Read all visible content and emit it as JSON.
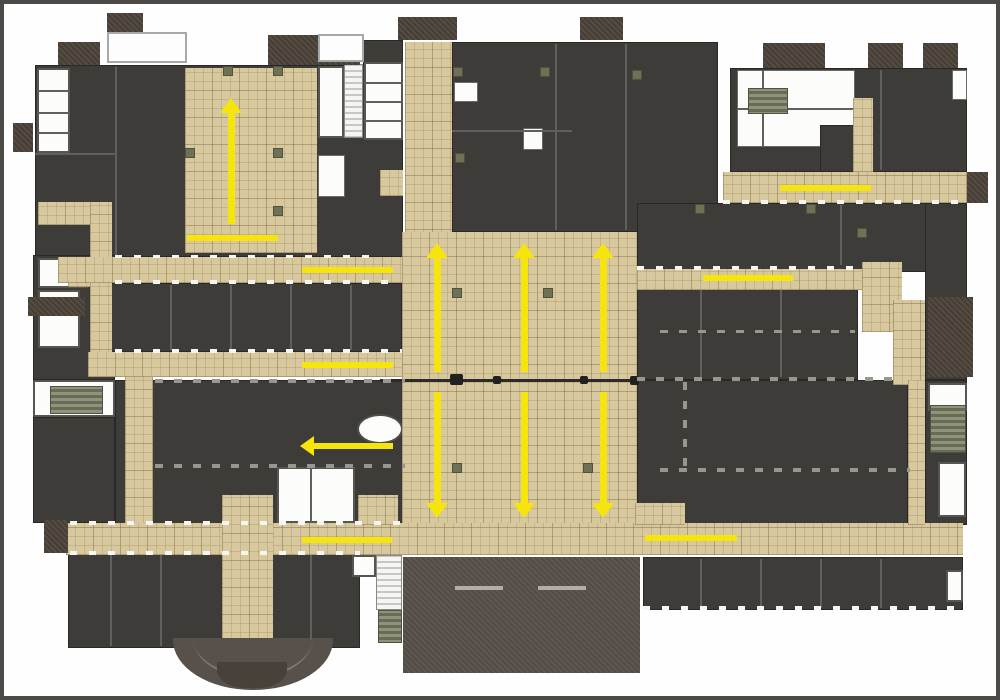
{
  "canvas": {
    "width": 1000,
    "height": 700,
    "background": "#fefefe",
    "frame_color": "#4c4a47"
  },
  "colors": {
    "corridor_tan": "#d8c89d",
    "room_dark": "#3e3c39",
    "roof_brown": "#4c4339",
    "auditorium_brown": "#57504a",
    "stair_olive": "#8e937c",
    "arrow_yellow": "#f5e50c",
    "wall_dark": "#2c2a27"
  },
  "floor_plan": {
    "regions": [
      [
        "ul-building",
        "dk",
        35,
        65,
        368,
        192
      ],
      [
        "strip-top-dark",
        "dk",
        363,
        40,
        40,
        25
      ],
      [
        "left-col-upper",
        "dk",
        33,
        255,
        82,
        125
      ],
      [
        "left-col-lower",
        "dk",
        33,
        417,
        82,
        106
      ],
      [
        "midleft-room-row",
        "dk",
        110,
        283,
        292,
        69
      ],
      [
        "midleft-hall",
        "dk",
        115,
        380,
        290,
        147
      ],
      [
        "bottomleft-building",
        "dk",
        68,
        553,
        292,
        95
      ],
      [
        "topcenter-building",
        "dk",
        452,
        42,
        266,
        190
      ],
      [
        "topright-building",
        "dk",
        730,
        68,
        237,
        104
      ],
      [
        "midright-upper",
        "dk",
        637,
        203,
        330,
        69
      ],
      [
        "midright-lower",
        "dk",
        637,
        287,
        221,
        93
      ],
      [
        "right-wing-upper",
        "dk",
        925,
        203,
        42,
        177
      ],
      [
        "bottomright-building",
        "dk",
        637,
        380,
        271,
        145
      ],
      [
        "right-wing-lower",
        "dk",
        925,
        380,
        42,
        145
      ],
      [
        "bottom-room-row",
        "dk",
        643,
        557,
        320,
        53
      ],
      [
        "auditorium-block",
        "aud",
        403,
        557,
        237,
        116
      ],
      [
        "ul-left-rooms",
        "white",
        37,
        68,
        33,
        85
      ],
      [
        "ul-left-div1",
        "wlineL",
        37,
        90,
        33,
        2
      ],
      [
        "ul-left-div2",
        "wlineL",
        37,
        112,
        33,
        2
      ],
      [
        "ul-left-div3",
        "wlineL",
        37,
        132,
        33,
        2
      ],
      [
        "ul-stairwell-white",
        "white",
        318,
        66,
        26,
        72
      ],
      [
        "ul-stairwell-stairs",
        "stairw",
        344,
        64,
        19,
        74
      ],
      [
        "ul-strip-rooms",
        "white",
        364,
        62,
        39,
        78
      ],
      [
        "ul-strip-div1",
        "wlineL",
        364,
        82,
        39,
        2
      ],
      [
        "ul-strip-div2",
        "wlineL",
        364,
        101,
        39,
        2
      ],
      [
        "ul-strip-div3",
        "wlineL",
        364,
        120,
        39,
        2
      ],
      [
        "ul-strip-white2",
        "whiteplain",
        318,
        155,
        27,
        42
      ],
      [
        "ul-strip-tan",
        "tan",
        380,
        170,
        23,
        26
      ],
      [
        "tc-room-white-a",
        "whiteplain",
        454,
        82,
        24,
        20
      ],
      [
        "tc-room-white-b",
        "whiteplain",
        523,
        128,
        20,
        22
      ],
      [
        "tr-courtyard",
        "whiteplain",
        737,
        70,
        118,
        77
      ],
      [
        "tr-court-div-v",
        "wlineL",
        762,
        70,
        2,
        77
      ],
      [
        "tr-court-div-h",
        "wlineL",
        737,
        108,
        118,
        2
      ],
      [
        "tr-stairs",
        "olive",
        748,
        88,
        40,
        26
      ],
      [
        "tr-court-room",
        "dk",
        820,
        125,
        35,
        47
      ],
      [
        "tr-white-notch",
        "whiteplain",
        952,
        70,
        15,
        30
      ],
      [
        "leftcol-room-a",
        "white",
        38,
        258,
        50,
        30
      ],
      [
        "leftcol-room-b",
        "white",
        38,
        290,
        42,
        58
      ],
      [
        "leftlow-rooms",
        "white",
        33,
        380,
        82,
        37
      ],
      [
        "leftlow-stairs",
        "olive",
        50,
        386,
        53,
        28
      ],
      [
        "midlow-rooms",
        "white",
        277,
        467,
        78,
        56
      ],
      [
        "midlow-div",
        "wlineL",
        310,
        467,
        2,
        56
      ],
      [
        "toilet-oval",
        "oval",
        357,
        414,
        46,
        30
      ],
      [
        "rightwing-room",
        "white",
        928,
        383,
        39,
        28
      ],
      [
        "rightwing-stairs",
        "olive",
        930,
        405,
        36,
        48
      ],
      [
        "br-room-white",
        "white",
        938,
        462,
        28,
        55
      ],
      [
        "bottomrow-room-white",
        "white",
        946,
        570,
        17,
        32
      ],
      [
        "bc-stair-white",
        "stairw",
        376,
        555,
        26,
        55
      ],
      [
        "bc-stairs",
        "olive",
        378,
        610,
        24,
        33
      ],
      [
        "bl-room-white",
        "white",
        352,
        555,
        24,
        22
      ],
      [
        "ul-plaza",
        "tan",
        185,
        68,
        132,
        185
      ],
      [
        "west-corr-h",
        "tan",
        38,
        202,
        72,
        23
      ],
      [
        "west-corr-v",
        "tan",
        90,
        202,
        22,
        175
      ],
      [
        "west-corr-stub",
        "tan",
        68,
        260,
        22,
        27
      ],
      [
        "corridor-north",
        "tan",
        58,
        257,
        349,
        26
      ],
      [
        "corridor-mid",
        "tan",
        88,
        352,
        317,
        25
      ],
      [
        "midleft-vert-corr",
        "tan",
        125,
        377,
        28,
        148
      ],
      [
        "central-spine",
        "tan",
        405,
        42,
        47,
        512
      ],
      [
        "central-plaza",
        "tan",
        402,
        232,
        235,
        322
      ],
      [
        "corridor-south",
        "tan",
        66,
        523,
        897,
        32
      ],
      [
        "corridor-northeast",
        "tan",
        723,
        172,
        244,
        31
      ],
      [
        "tr-vert-corr",
        "tan",
        853,
        98,
        20,
        74
      ],
      [
        "corridor-east",
        "tan",
        637,
        269,
        230,
        21
      ],
      [
        "east-junction-a",
        "tan",
        862,
        262,
        40,
        70
      ],
      [
        "east-junction-b",
        "tan",
        893,
        300,
        32,
        85
      ],
      [
        "east-vert-strip",
        "tan",
        908,
        380,
        17,
        145
      ],
      [
        "br-tan-block",
        "tan",
        635,
        503,
        50,
        22
      ],
      [
        "midlow-tan",
        "tan",
        358,
        495,
        40,
        30
      ],
      [
        "bl-vert-corr",
        "tan",
        222,
        495,
        51,
        147
      ],
      [
        "roof-stub-1",
        "brown",
        107,
        13,
        36,
        22
      ],
      [
        "roof-stub-2",
        "brown",
        58,
        42,
        42,
        23
      ],
      [
        "roof-stub-3",
        "brown",
        268,
        35,
        92,
        30
      ],
      [
        "roof-stub-4",
        "brown",
        398,
        17,
        59,
        23
      ],
      [
        "roof-stub-5",
        "brown",
        580,
        17,
        43,
        23
      ],
      [
        "roof-stub-6",
        "brown",
        763,
        43,
        62,
        25
      ],
      [
        "roof-stub-7",
        "brown",
        868,
        43,
        35,
        25
      ],
      [
        "roof-stub-8",
        "brown",
        923,
        43,
        35,
        25
      ],
      [
        "roof-stub-west-a",
        "brown",
        13,
        123,
        20,
        29
      ],
      [
        "roof-stub-west-b",
        "brown",
        28,
        297,
        57,
        19
      ],
      [
        "roof-stub-west-c",
        "brown",
        44,
        520,
        24,
        33
      ],
      [
        "roof-stub-east",
        "brown",
        967,
        172,
        21,
        31
      ],
      [
        "roof-block-east",
        "brown",
        928,
        297,
        45,
        80
      ],
      [
        "skylight-1",
        "skylight",
        107,
        32,
        80,
        31
      ],
      [
        "skylight-2",
        "skylight",
        318,
        34,
        46,
        28
      ],
      [
        "entry-fan",
        "fan",
        173,
        638,
        160,
        52
      ],
      [
        "entry-fan-arc",
        "fanline",
        193,
        638,
        120,
        40
      ],
      [
        "entry-fan-stub",
        "fanstub",
        217,
        662,
        70,
        26
      ],
      [
        "stage-line-1",
        "stageline",
        455,
        586,
        48,
        4
      ],
      [
        "stage-line-2",
        "stageline",
        538,
        586,
        48,
        4
      ],
      [
        "plaza-joint-line",
        "linedark",
        380,
        379,
        257,
        3
      ],
      [
        "joint-door-1",
        "blob",
        450,
        374,
        13,
        11
      ],
      [
        "joint-door-2",
        "blob",
        493,
        376,
        8,
        8
      ],
      [
        "joint-door-3",
        "blob",
        580,
        376,
        8,
        8
      ],
      [
        "joint-door-4",
        "blob",
        630,
        376,
        9,
        9
      ],
      [
        "div-ul-v",
        "wlineL",
        115,
        67,
        2,
        188
      ],
      [
        "div-ul-h",
        "wlineL",
        35,
        153,
        80,
        2
      ],
      [
        "div-tc-v1",
        "wlineL",
        555,
        44,
        2,
        186
      ],
      [
        "div-tc-v2",
        "wlineL",
        625,
        44,
        2,
        186
      ],
      [
        "div-tc-h",
        "wlineL",
        452,
        130,
        120,
        2
      ],
      [
        "div-tr-v",
        "wlineL",
        880,
        70,
        2,
        100
      ],
      [
        "div-mr-v1",
        "wlineL",
        700,
        290,
        2,
        87
      ],
      [
        "div-mr-v2",
        "wlineL",
        780,
        290,
        2,
        87
      ],
      [
        "div-mr-v3",
        "wlineL",
        840,
        205,
        2,
        60
      ],
      [
        "div-row-1",
        "wlineL",
        170,
        285,
        2,
        65
      ],
      [
        "div-row-2",
        "wlineL",
        230,
        285,
        2,
        65
      ],
      [
        "div-row-3",
        "wlineL",
        290,
        285,
        2,
        65
      ],
      [
        "div-row-4",
        "wlineL",
        350,
        285,
        2,
        65
      ],
      [
        "div-bl-1",
        "wlineL",
        110,
        555,
        2,
        91
      ],
      [
        "div-bl-2",
        "wlineL",
        160,
        555,
        2,
        91
      ],
      [
        "div-bl-3",
        "wlineL",
        310,
        555,
        2,
        85
      ],
      [
        "div-brow-1",
        "wlineL",
        700,
        559,
        2,
        49
      ],
      [
        "div-brow-2",
        "wlineL",
        760,
        559,
        2,
        49
      ],
      [
        "div-brow-3",
        "wlineL",
        820,
        559,
        2,
        49
      ],
      [
        "div-brow-4",
        "wlineL",
        880,
        559,
        2,
        49
      ],
      [
        "gaps-corrN-bottom",
        "dash",
        115,
        280,
        285,
        4
      ],
      [
        "gaps-corrM-top",
        "dash",
        115,
        349,
        287,
        4
      ],
      [
        "wall-dashed-1",
        "dashg",
        155,
        379,
        250,
        4
      ],
      [
        "wall-dashed-2",
        "dashg",
        155,
        464,
        250,
        4
      ],
      [
        "gaps-corrS-top",
        "dash",
        70,
        521,
        330,
        4
      ],
      [
        "gaps-corrS-bottom",
        "dash",
        70,
        551,
        290,
        4
      ],
      [
        "wall-dashed-br-top",
        "dashg",
        637,
        377,
        260,
        4
      ],
      [
        "wall-dashed-br-mid",
        "dashg",
        660,
        468,
        250,
        4
      ],
      [
        "wall-dashed-br-v",
        "dashgv",
        683,
        382,
        4,
        86
      ],
      [
        "gaps-bottomrow",
        "dash",
        643,
        606,
        320,
        4
      ],
      [
        "gaps-corrNE-bottom",
        "dash",
        723,
        200,
        244,
        4
      ],
      [
        "gaps-corrE-top",
        "dash",
        637,
        266,
        223,
        4
      ],
      [
        "gaps-ul-bottom",
        "dash",
        115,
        255,
        257,
        3
      ],
      [
        "wall-dashed-mr",
        "dashg",
        660,
        330,
        195,
        3
      ],
      [
        "column-1",
        "col",
        453,
        67,
        10,
        10
      ],
      [
        "column-2",
        "col",
        540,
        67,
        10,
        10
      ],
      [
        "column-3",
        "col",
        632,
        70,
        10,
        10
      ],
      [
        "column-4",
        "col",
        455,
        153,
        10,
        10
      ],
      [
        "column-5",
        "col",
        223,
        66,
        10,
        10
      ],
      [
        "column-6",
        "col",
        273,
        66,
        10,
        10
      ],
      [
        "column-7",
        "col",
        273,
        148,
        10,
        10
      ],
      [
        "column-8",
        "col",
        273,
        206,
        10,
        10
      ],
      [
        "column-9",
        "col",
        185,
        148,
        10,
        10
      ],
      [
        "column-10",
        "col",
        452,
        288,
        10,
        10
      ],
      [
        "column-11",
        "col",
        543,
        288,
        10,
        10
      ],
      [
        "column-12",
        "col",
        452,
        463,
        10,
        10
      ],
      [
        "column-13",
        "col",
        583,
        463,
        10,
        10
      ],
      [
        "column-14",
        "col",
        806,
        204,
        10,
        10
      ],
      [
        "column-15",
        "col",
        695,
        204,
        10,
        10
      ],
      [
        "column-16",
        "col",
        857,
        228,
        10,
        10
      ]
    ],
    "circulation": {
      "up_arrows": [
        {
          "cx": 231,
          "tip": 98,
          "end": 224
        },
        {
          "cx": 437,
          "tip": 243,
          "end": 372
        },
        {
          "cx": 524,
          "tip": 243,
          "end": 372
        },
        {
          "cx": 603,
          "tip": 243,
          "end": 372
        }
      ],
      "down_arrows": [
        {
          "cx": 437,
          "start": 392,
          "tip": 518
        },
        {
          "cx": 524,
          "start": 392,
          "tip": 518
        },
        {
          "cx": 603,
          "start": 392,
          "tip": 518
        }
      ],
      "left_arrows": [
        {
          "cy": 446,
          "tip": 300,
          "end": 393
        }
      ],
      "flow_lines": [
        [
          187,
          235,
          91,
          6
        ],
        [
          302,
          267,
          91,
          6
        ],
        [
          302,
          362,
          91,
          6
        ],
        [
          302,
          537,
          90,
          6
        ],
        [
          780,
          185,
          91,
          6
        ],
        [
          703,
          275,
          90,
          6
        ],
        [
          645,
          535,
          92,
          6
        ]
      ]
    }
  }
}
